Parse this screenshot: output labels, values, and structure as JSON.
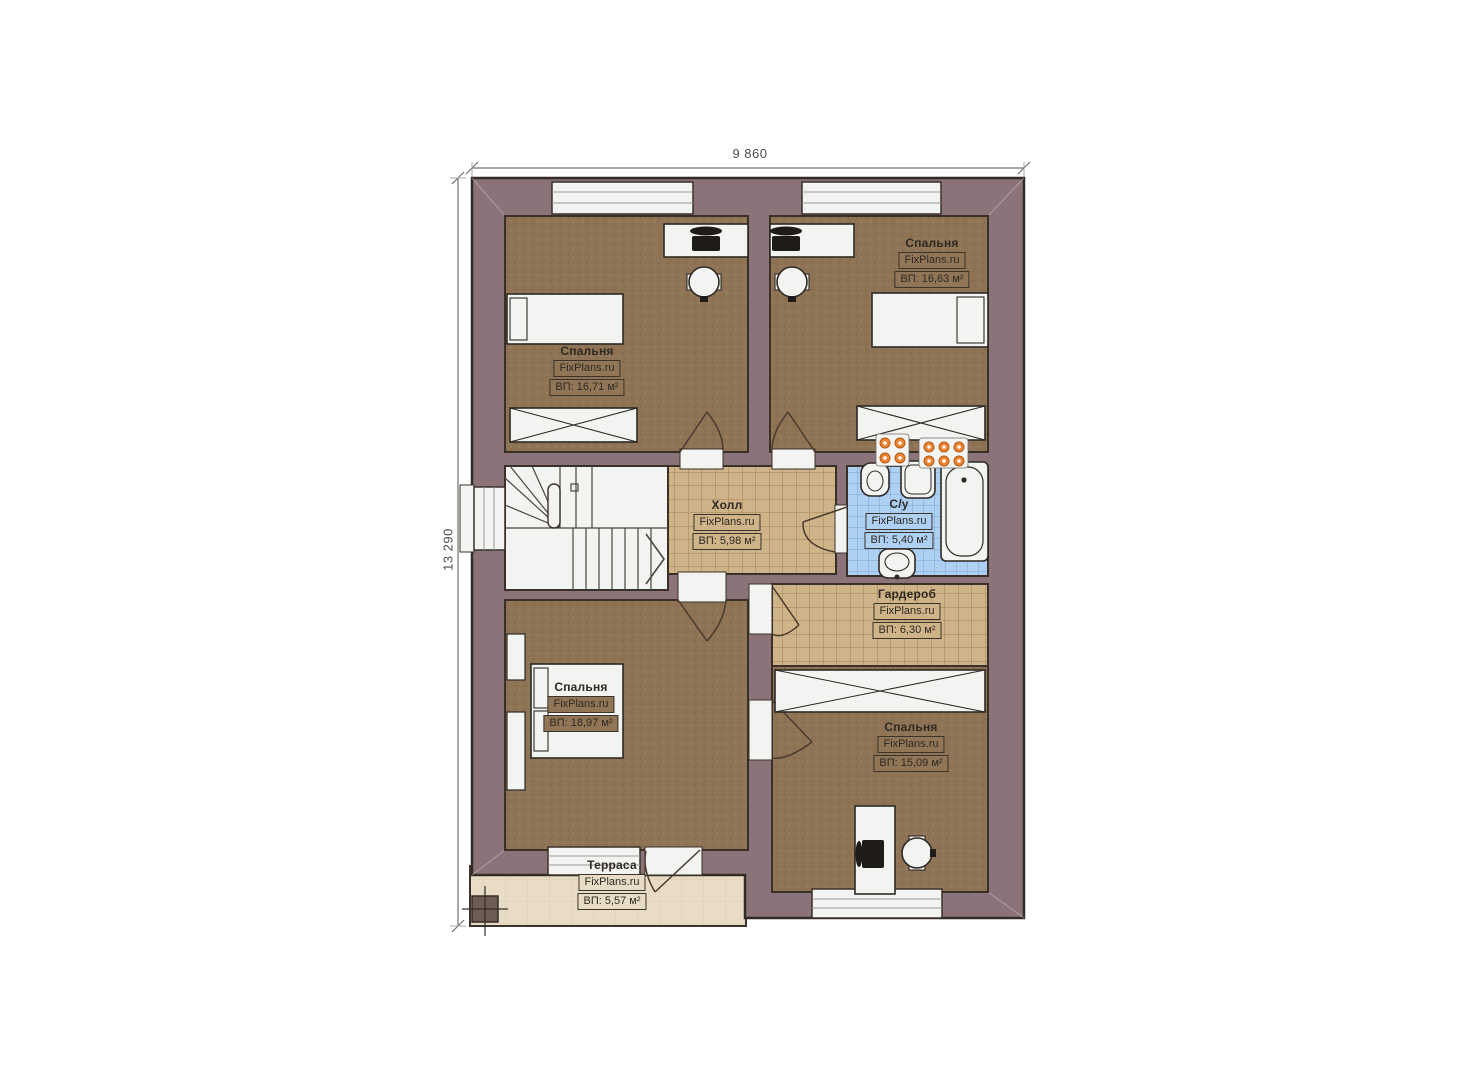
{
  "dimensions": {
    "width": "9 860",
    "height": "13 290"
  },
  "rooms": [
    {
      "id": "bedroom-top-left",
      "name": "Спальня",
      "brand": "FixPlans.ru",
      "area": "ВП: 16,71 м²"
    },
    {
      "id": "bedroom-top-right",
      "name": "Спальня",
      "brand": "FixPlans.ru",
      "area": "ВП: 16,63 м²"
    },
    {
      "id": "hall",
      "name": "Холл",
      "brand": "FixPlans.ru",
      "area": "ВП: 5,98 м²"
    },
    {
      "id": "bathroom",
      "name": "С/у",
      "brand": "FixPlans.ru",
      "area": "ВП: 5,40 м²"
    },
    {
      "id": "wardrobe",
      "name": "Гардероб",
      "brand": "FixPlans.ru",
      "area": "ВП: 6,30 м²"
    },
    {
      "id": "bedroom-bottom-left",
      "name": "Спальня",
      "brand": "FixPlans.ru",
      "area": "ВП: 18,97 м²"
    },
    {
      "id": "bedroom-bottom-right",
      "name": "Спальня",
      "brand": "FixPlans.ru",
      "area": "ВП: 15,09 м²"
    },
    {
      "id": "terrace",
      "name": "Терраса",
      "brand": "FixPlans.ru",
      "area": "ВП: 5,57 м²"
    }
  ],
  "colors": {
    "wall": "#8a7379",
    "bedroom_floor": "#8e7455",
    "tile_tan": "#cfb389",
    "tile_blue": "#aed0f2",
    "terrace": "#e9dcc6",
    "furniture_white": "#f3f3f1",
    "outline": "#332c26",
    "radiator_orange": "#ed8434"
  }
}
